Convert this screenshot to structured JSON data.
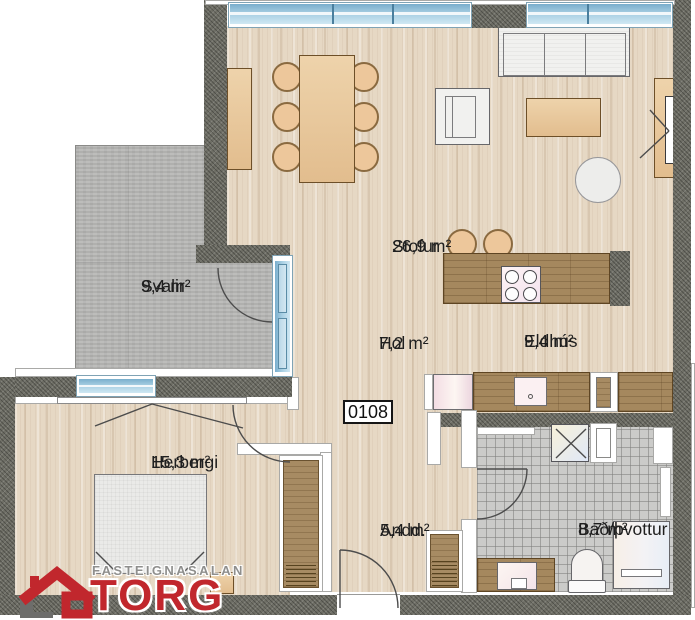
{
  "plan": {
    "unit_number": "0108",
    "rooms": [
      {
        "id": "svalir",
        "name": "Svalir",
        "area": "9,4 m²"
      },
      {
        "id": "stofur",
        "name": "Stofur",
        "area": "26,9 m²"
      },
      {
        "id": "hol",
        "name": "Hol",
        "area": "7,2 m²"
      },
      {
        "id": "eldhus",
        "name": "Eldhús",
        "area": "9,4 m²"
      },
      {
        "id": "herbergi",
        "name": "Herbergi",
        "area": "15,3 m²"
      },
      {
        "id": "andd",
        "name": "Andd.",
        "area": "5,4 m²"
      },
      {
        "id": "bad",
        "name": "Bað/þvottur",
        "area": "8,7 m²"
      }
    ],
    "logo": {
      "tagline": "FASTEIGNASALAN",
      "brand": "TORG",
      "brand_color": "#c1272d",
      "tagline_color": "#8f8f8d"
    },
    "colors": {
      "exterior_wall": "#6f6f66",
      "wood_floor": "#e6d8c4",
      "balcony_concrete": "#b9b9b7",
      "window_glazing": "#a6cee2",
      "counter_wood": "#a5885e",
      "bath_tile": "#cbcbc9"
    }
  }
}
